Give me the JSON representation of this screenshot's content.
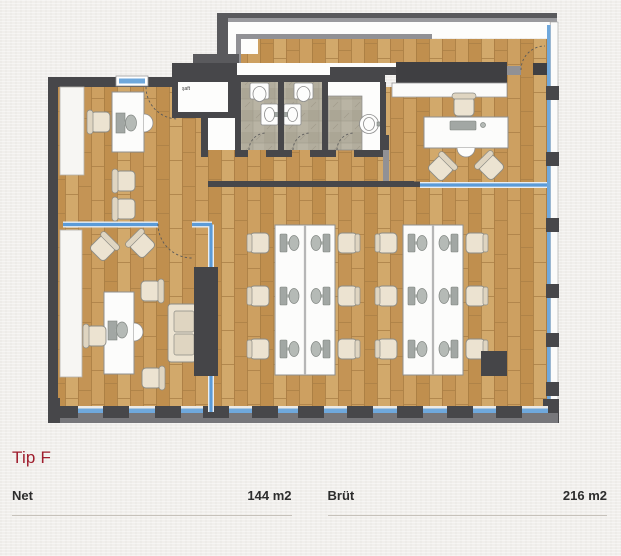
{
  "plan": {
    "room_labels": [
      {
        "text": "şaft"
      }
    ],
    "colors": {
      "wall_dark": "#47474a",
      "outer_band_gray": "#5a5a5d",
      "glass_blue": "#5b9bd8",
      "window_blue": "#6fa8dc",
      "floor_wood": "#c89a5c",
      "bathroom_tile": "#b2ad9d",
      "furniture_white": "#fcfcfb",
      "chair_cream": "#ece3d1",
      "cabinet_dark": "#454548"
    }
  },
  "details": {
    "title": "Tip F",
    "title_color": "#9f1d2d",
    "stats": [
      {
        "label": "Net",
        "value": "144 m2"
      },
      {
        "label": "Brüt",
        "value": "216 m2"
      }
    ]
  }
}
